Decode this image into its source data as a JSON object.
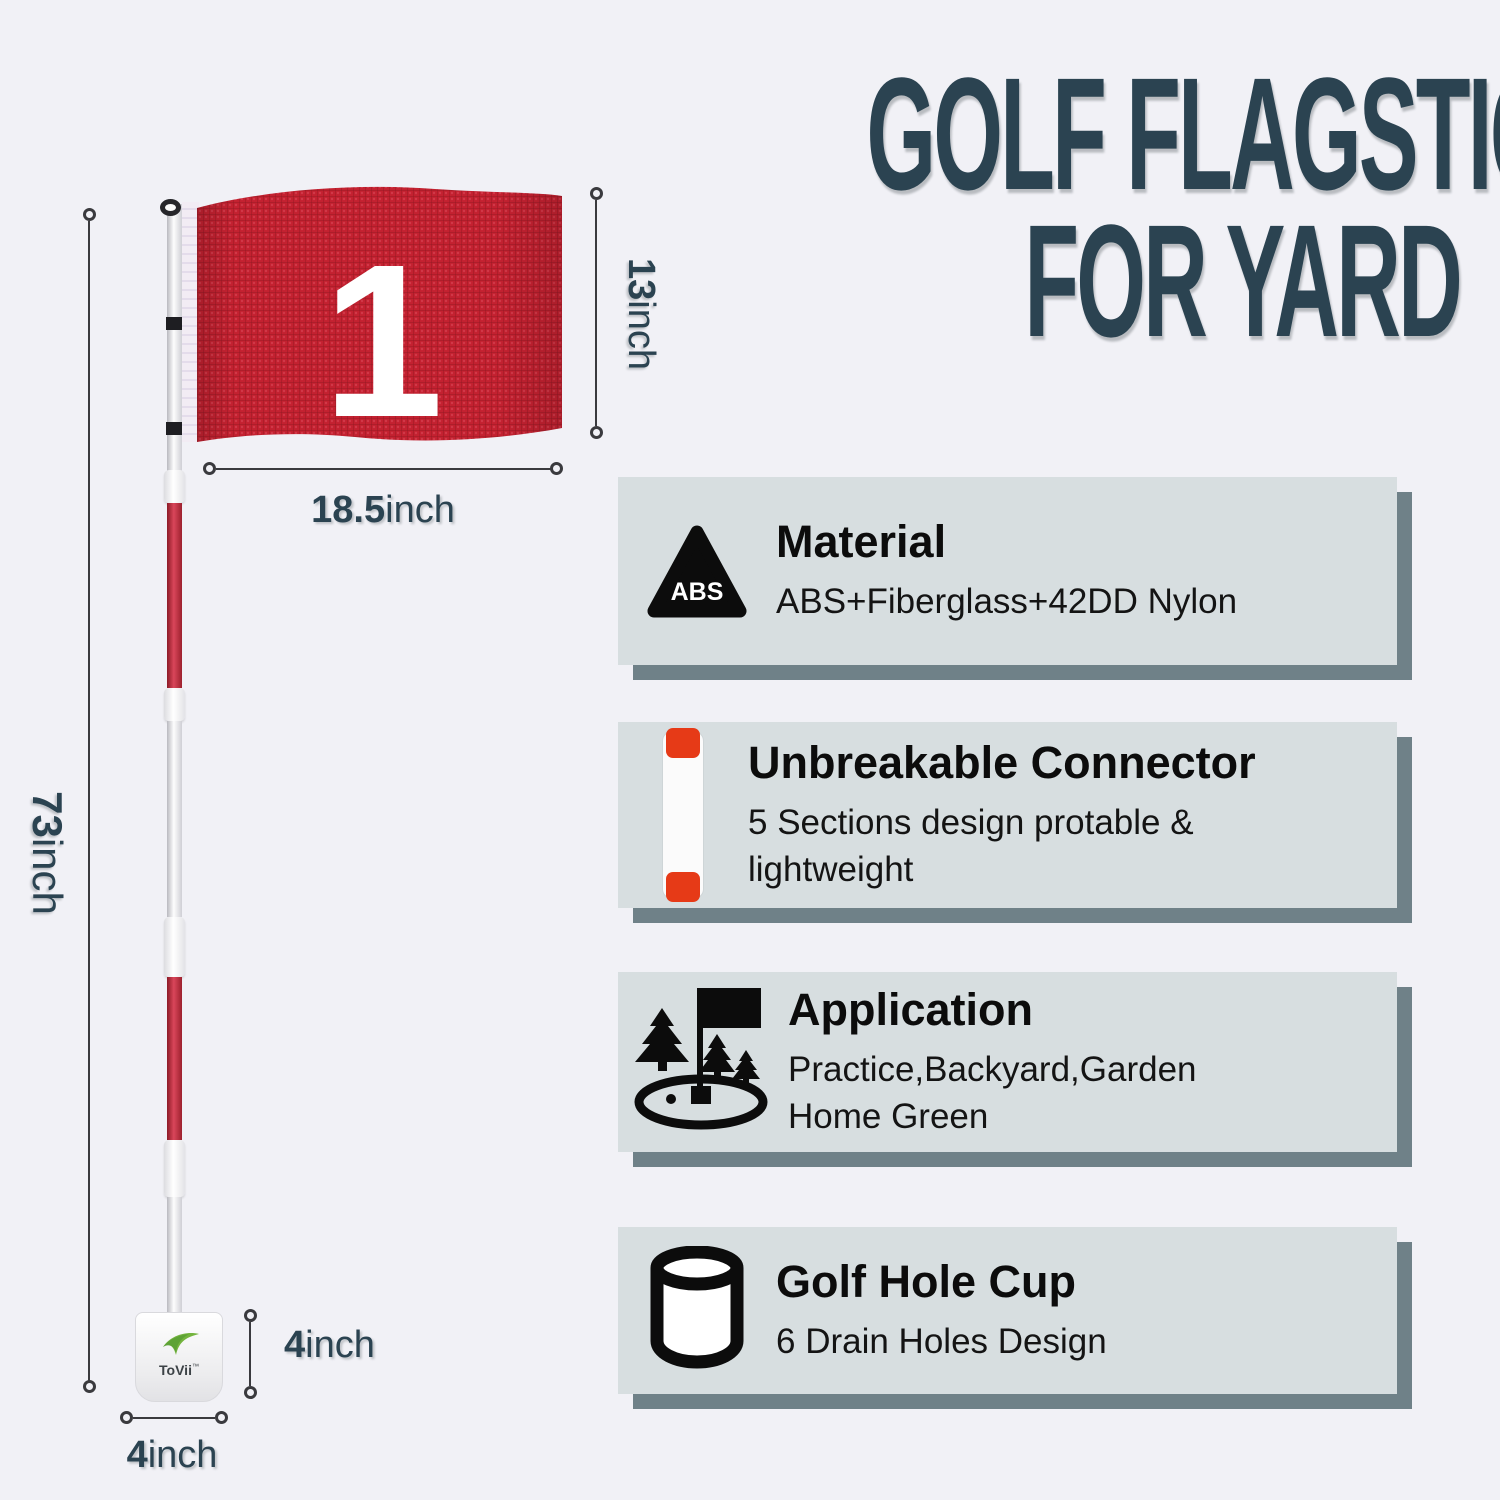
{
  "title": {
    "line1": "GOLF FLAGSTICK",
    "line2": "FOR YARD",
    "color": "#2b4351"
  },
  "figure": {
    "flag_number": "1",
    "brand": "ToVii",
    "brand_mark": "™",
    "flag_color": "#c32130",
    "pole_red": "#9d212e",
    "dimensions": {
      "flag_height_value": "13",
      "flag_height_unit": "inch",
      "flag_width_value": "18.5",
      "flag_width_unit": "inch",
      "pole_height_value": "73",
      "pole_height_unit": "inch",
      "cup_height_value": "4",
      "cup_height_unit": "inch",
      "cup_diameter_value": "4",
      "cup_diameter_unit": "inch"
    }
  },
  "features": [
    {
      "icon": "abs-triangle-icon",
      "icon_label": "ABS",
      "heading": "Material",
      "description": "ABS+Fiberglass+42DD Nylon"
    },
    {
      "icon": "pole-connector-icon",
      "heading": "Unbreakable Connector",
      "description": "5 Sections design protable &\nlightweight"
    },
    {
      "icon": "golf-green-icon",
      "heading": "Application",
      "description": "Practice,Backyard,Garden\nHome Green"
    },
    {
      "icon": "golf-hole-cup-icon",
      "heading": "Golf Hole Cup",
      "description": "6 Drain Holes Design"
    }
  ],
  "colors": {
    "card_bg": "#d7dee0",
    "card_shadow": "#6f8188",
    "accent_red": "#e63a17",
    "text_dark": "#2b4351",
    "page_bg": "#f1f1f6"
  }
}
